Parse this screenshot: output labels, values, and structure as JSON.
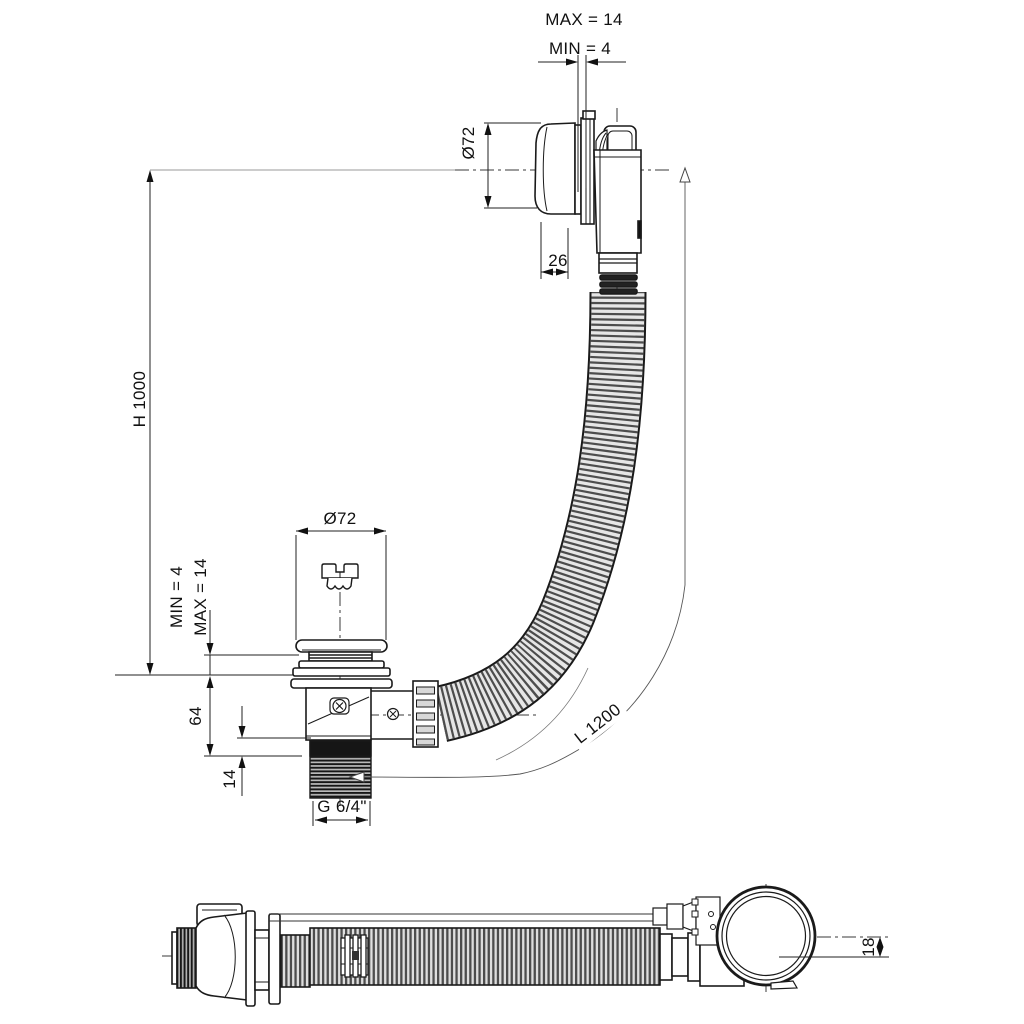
{
  "drawing": {
    "type": "technical-drawing",
    "subject": "bath waste and overflow set with flexible hose",
    "colors": {
      "background": "#ffffff",
      "line": "#1a1a1a",
      "centerline": "#3a3a3a",
      "hose_rib": "#4d4d4d",
      "hose_fill": "#e6e6e6",
      "thread_dark": "#161616",
      "extension_line": "#9a9a9a"
    },
    "front_view": {
      "dimensions": {
        "wall_gap_max": "MAX = 14",
        "wall_gap_min": "MIN = 4",
        "overflow_diameter": "Ø72",
        "overflow_cap_depth": "26",
        "overall_height": "H 1000",
        "floor_gap_min": "MIN = 4",
        "floor_gap_max": "MAX = 14",
        "body_height": "64",
        "thread_free_length": "14",
        "thread_size": "G 6/4\"",
        "hose_length": "L 1200",
        "plug_diameter": "Ø72"
      }
    },
    "side_view": {
      "dimensions": {
        "axis_offset": "18"
      }
    }
  }
}
